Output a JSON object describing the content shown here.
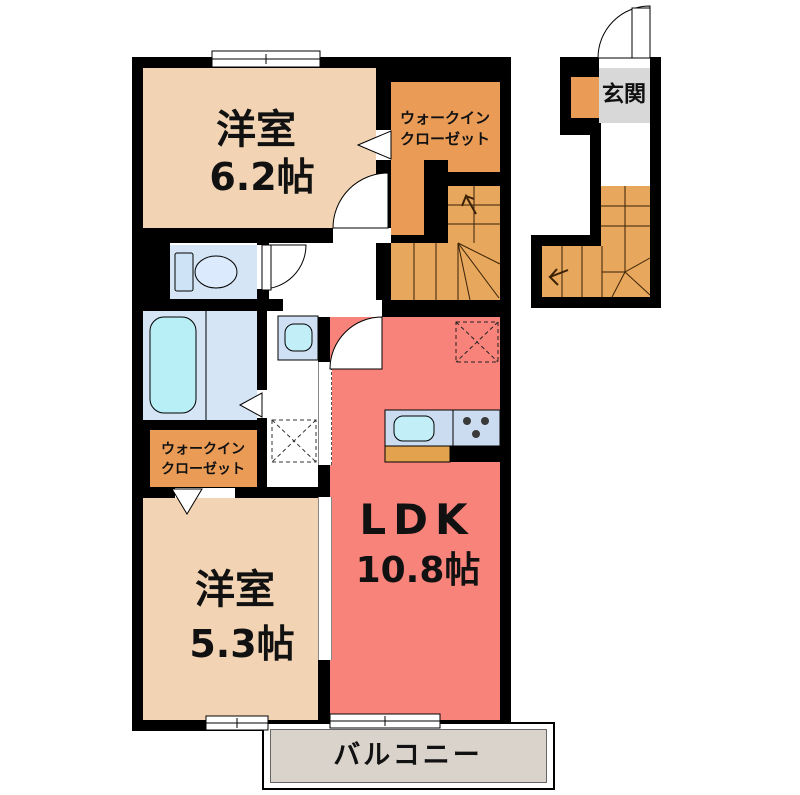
{
  "plan": {
    "rooms": {
      "bedroom1": {
        "name": "洋室",
        "size": "6.2帖"
      },
      "wic_upper": {
        "line1": "ウォークイン",
        "line2": "クローゼット"
      },
      "genkan": {
        "name": "玄関"
      },
      "ldk": {
        "name": "LDK",
        "size": "10.8帖"
      },
      "bedroom2": {
        "name": "洋室",
        "size": "5.3帖"
      },
      "wic_lower": {
        "line1": "ウォークイン",
        "line2": "クローゼット"
      },
      "balcony": {
        "name": "バルコニー"
      }
    },
    "colors": {
      "wall": "#000000",
      "bedroom_floor": "#f2d4b4",
      "closet_floor": "#ea9c57",
      "stairs_floor": "#e7a75d",
      "ldk_floor": "#f8837b",
      "wet_room_floor": "#d5e5f6",
      "bathtub": "#b8eef6",
      "kitchen_counter": "#ccdcf0",
      "counter_top": "#e2a24e",
      "genkan_floor": "#d8d8d8",
      "balcony_floor": "#d9d3cb"
    },
    "fixtures": {
      "toilet": "toilet-icon",
      "bathtub": "bathtub-icon",
      "washbasin": "washbasin-icon",
      "kitchen_sink": "kitchen-sink-icon",
      "stove": "stove-burners-icon",
      "washer_space": "washing-machine-space",
      "fridge_space": "refrigerator-space",
      "stairs_main": "staircase",
      "stairs_entrance": "staircase",
      "entrance_door": "entrance-door"
    }
  }
}
